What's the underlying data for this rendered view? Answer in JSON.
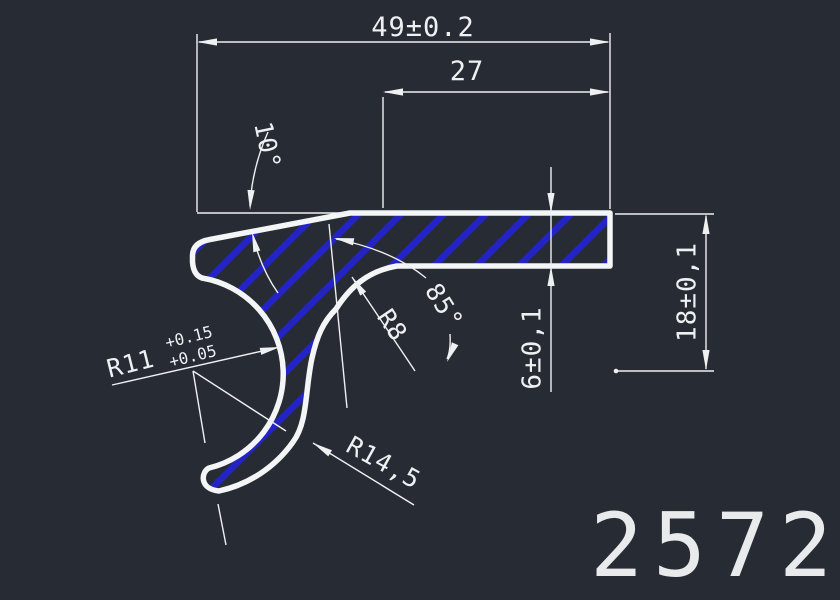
{
  "drawing": {
    "part_number": "2572",
    "dimensions": {
      "overall_width": "49±0.2",
      "flange_width": "27",
      "top_angle": "10°",
      "hook_angle": "85°",
      "fillet_radius": "R8",
      "inner_radius": "R11",
      "inner_radius_tol_upper": "+0.15",
      "inner_radius_tol_lower": "+0.05",
      "outer_radius": "R14,5",
      "flange_thickness": "6±0,1",
      "overall_height": "18±0,1"
    },
    "colors": {
      "background": "#272c34",
      "line": "#eef0f2",
      "hatch": "#2323c8"
    }
  }
}
